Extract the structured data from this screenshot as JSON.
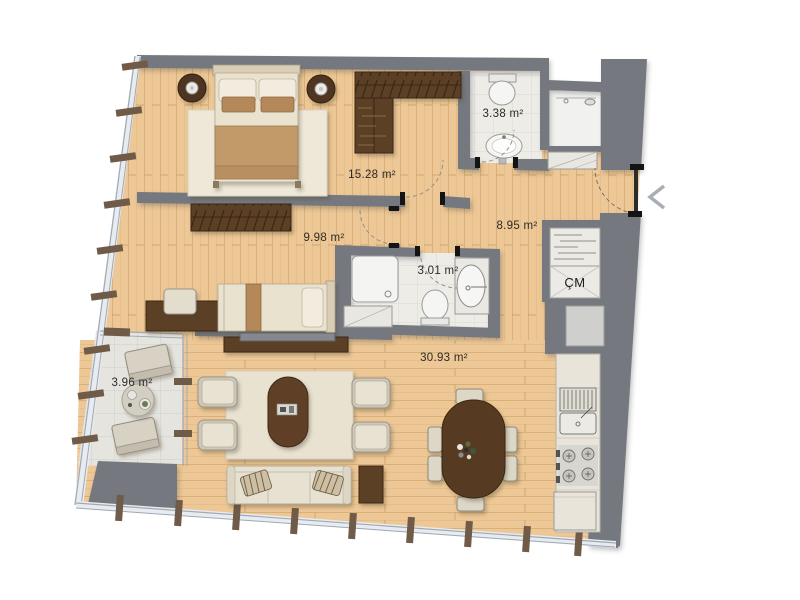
{
  "plan": {
    "rooms": [
      {
        "id": "bedroom-1",
        "area_label": "15.28 m²"
      },
      {
        "id": "bedroom-2",
        "area_label": "9.98 m²"
      },
      {
        "id": "living-room",
        "area_label": "30.93 m²"
      },
      {
        "id": "hall",
        "area_label": "8.95 m²"
      },
      {
        "id": "bathroom-1",
        "area_label": "3.38 m²"
      },
      {
        "id": "bathroom-2",
        "area_label": "3.01 m²"
      },
      {
        "id": "balcony",
        "area_label": "3.96 m²"
      }
    ],
    "kitchen": {
      "washing_machine_label": "ÇM"
    },
    "icons": {
      "entrance_chevron": "left-chevron"
    },
    "colors": {
      "wall": "#75797f",
      "wood_floor": "#edc795",
      "tile": "#edece7",
      "dark_wood": "#5c3f26",
      "upholstery": "#e7e1d1",
      "glass": "#9fa9b4",
      "chevron": "#a8aeb4"
    }
  }
}
